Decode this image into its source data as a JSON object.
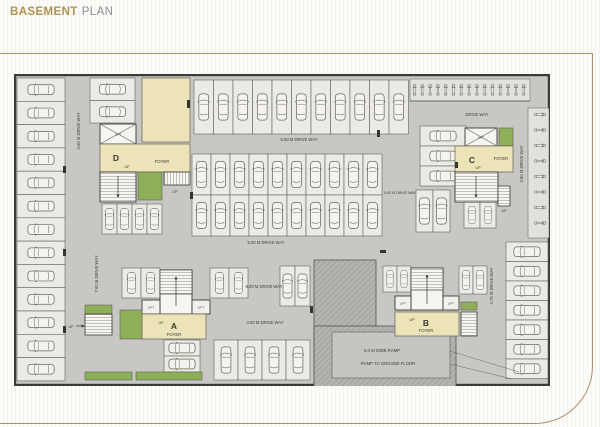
{
  "header": {
    "title_bold": "BASEMENT",
    "title_light": "PLAN"
  },
  "plan": {
    "blocks": {
      "a": "A",
      "b": "B",
      "c": "C",
      "d": "D"
    },
    "labels": {
      "lift": "LIFT",
      "up": "UP",
      "foyer": "FOYER",
      "drive_way": "DRIVE WAY",
      "dw_450": "4.50 M DRIVE WAY",
      "dw_760": "7.60 M DRIVE WAY",
      "dw_280": "2.80 M DRIVE WAY",
      "dw_475": "4.75 M DRIVE WAY",
      "dw_500": "5.00 M DRIVE WAY",
      "dw_600": "6.00 M DRIVE WAY",
      "dw_400": "4.00 M DRIVE WAY",
      "ramp_width": "6.0 M WIDE RAMP",
      "ramp_dest": "RAMP TO GROUND FLOOR"
    },
    "colors": {
      "title_accent": "#b2924e",
      "foyer": "#ece3b8",
      "landscape": "#8fae58",
      "drive": "#c8c7c3",
      "stall": "#ebeae5",
      "ramp": "#b4b3af"
    }
  }
}
